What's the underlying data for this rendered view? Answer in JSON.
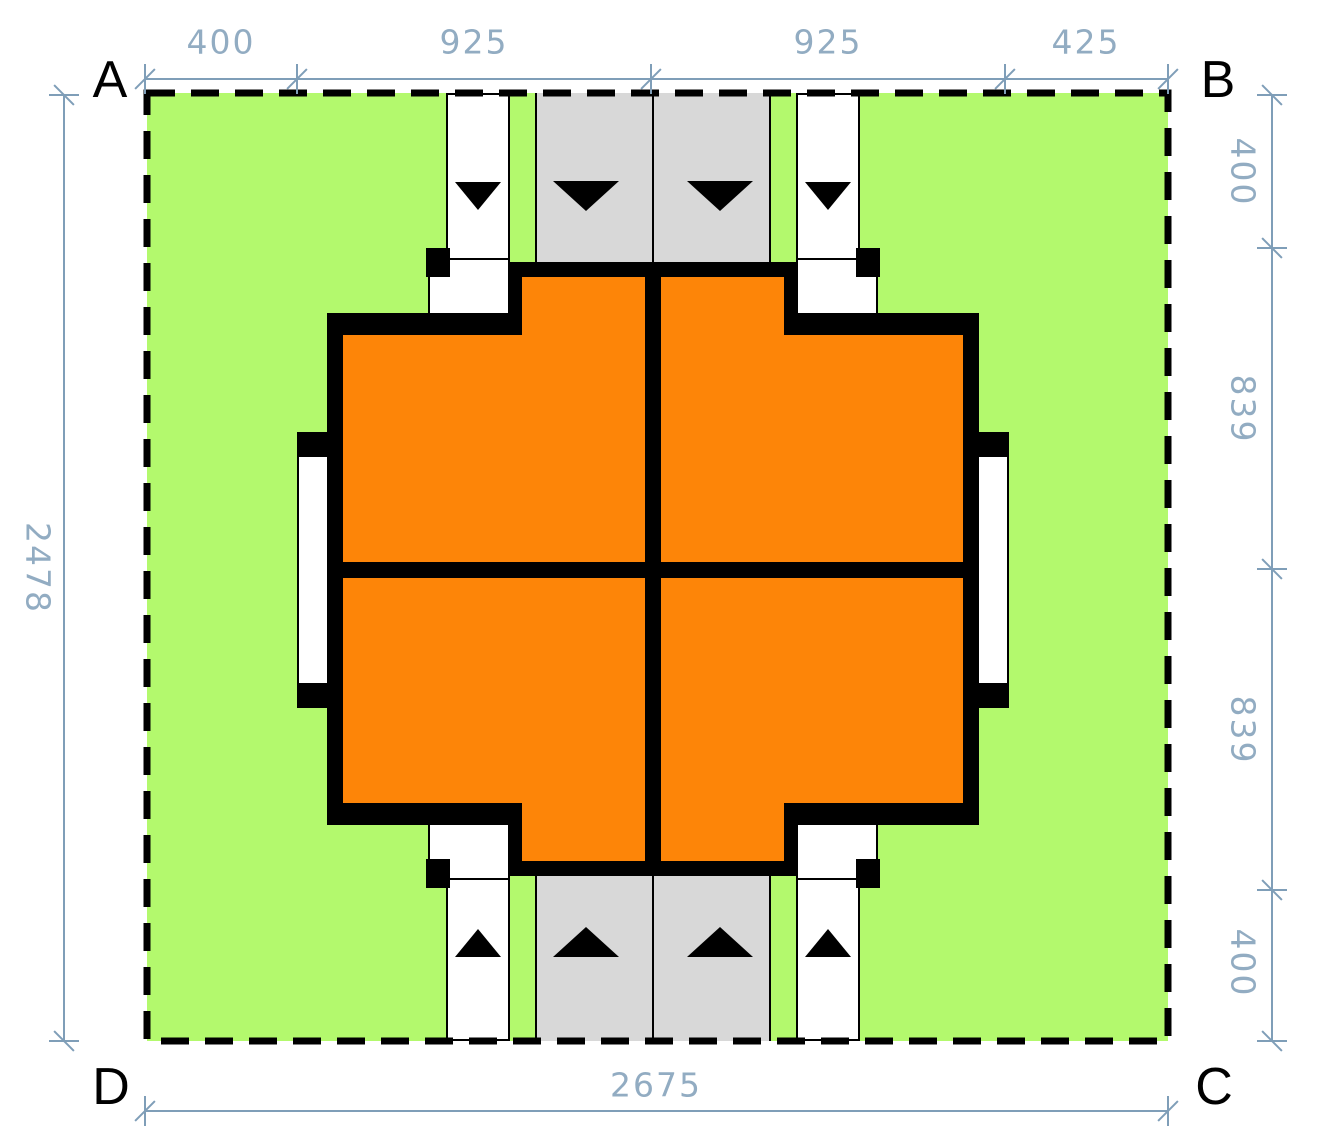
{
  "corner_labels": {
    "top_left": "A",
    "top_right": "B",
    "bottom_right": "C",
    "bottom_left": "D"
  },
  "dimensions": {
    "top": [
      "400",
      "925",
      "925",
      "425"
    ],
    "right": [
      "400",
      "839",
      "839",
      "400"
    ],
    "left": [
      "2478"
    ],
    "bottom": [
      "2675"
    ]
  },
  "colors": {
    "lawn": "#b3f96d",
    "building": "#fd8508",
    "road": "#d8d8d8",
    "wall": "#000000",
    "dim": "#7f9eb8"
  },
  "arrows": {
    "top_row_direction": "down",
    "bottom_row_direction": "up"
  }
}
